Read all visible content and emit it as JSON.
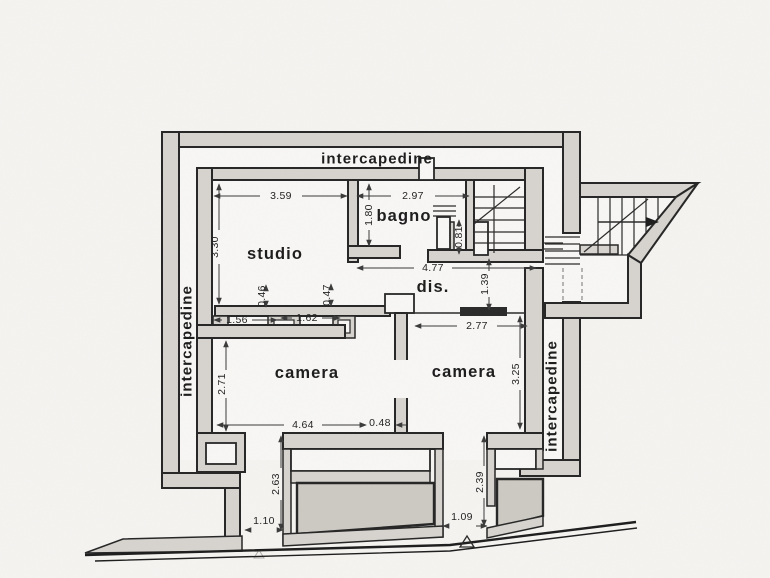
{
  "plan": {
    "rooms": {
      "studio": "studio",
      "bagno": "bagno",
      "dis": "dis.",
      "camera_left": "camera",
      "camera_right": "camera"
    },
    "corridors": {
      "top": "intercapedine",
      "left": "intercapedine",
      "right": "intercapedine"
    },
    "dimensions": {
      "studio_width": "3.59",
      "bagno_width": "2.97",
      "bagno_depth": "1.80",
      "niche_width": "0.81",
      "studio_depth": "3.30",
      "pier_left": "0.46",
      "pier_right": "0.47",
      "hall_width": "4.77",
      "hall_depth": "1.39",
      "opening_left": "1.56",
      "opening_right": "1.62",
      "camera_right_width": "2.77",
      "camera_left_depth": "2.71",
      "camera_right_depth": "3.25",
      "camera_left_width": "4.64",
      "partition_gap": "0.48",
      "lightwell_left_depth": "2.63",
      "lightwell_right_depth": "2.39",
      "gap_left": "1.10",
      "gap_right": "1.09"
    },
    "colors": {
      "paper": "#f5f4f1",
      "room_floor": "#f8f7f5",
      "wall_fill": "#d7d4cf",
      "wall_line": "#262626",
      "dim_text": "#222222"
    }
  }
}
